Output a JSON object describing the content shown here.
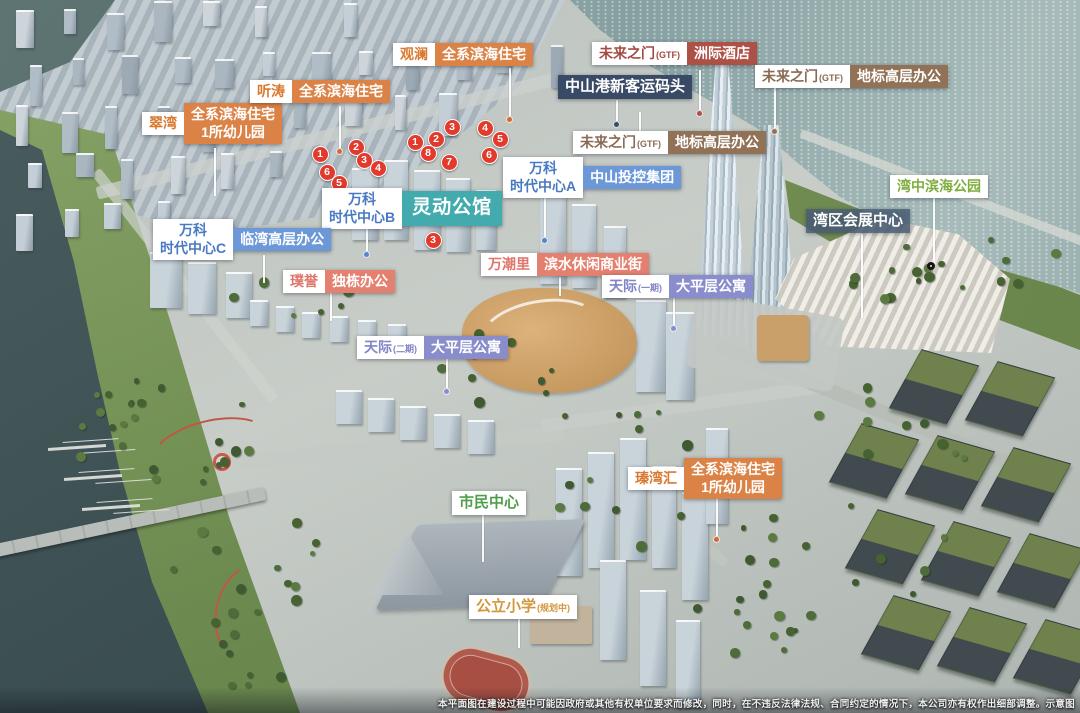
{
  "labels": {
    "cuiwan": {
      "name": "翠湾",
      "desc1": "全系滨海住宅",
      "desc2": "1所幼儿园"
    },
    "tingtao": {
      "name": "听涛",
      "desc": "全系滨海住宅"
    },
    "guanlan": {
      "name": "观澜",
      "desc": "全系滨海住宅"
    },
    "gangkou": {
      "name": "中山港新客运码头"
    },
    "weilai_hotel": {
      "name": "未来之门",
      "suffix": "(GTF)",
      "desc": "洲际酒店"
    },
    "weilai_right": {
      "name": "未来之门",
      "suffix": "(GTF)",
      "desc": "地标高层办公"
    },
    "weilai_lower": {
      "name": "未来之门",
      "suffix": "(GTF)",
      "desc": "地标高层办公"
    },
    "vanke_a": {
      "name1": "万科",
      "name2": "时代中心A",
      "desc": "中山投控集团"
    },
    "vanke_b": {
      "name1": "万科",
      "name2": "时代中心B",
      "desc": "灵动公馆"
    },
    "vanke_c": {
      "name1": "万科",
      "name2": "时代中心C",
      "desc": "临湾高层办公"
    },
    "puyu": {
      "name": "璞誉",
      "desc": "独栋办公"
    },
    "wanchaoli": {
      "name": "万潮里",
      "desc": "滨水休闲商业街"
    },
    "tianji1": {
      "name": "天际",
      "suffix": "(一期)",
      "desc": "大平层公寓"
    },
    "tianji2": {
      "name": "天际",
      "suffix": "(二期)",
      "desc": "大平层公寓"
    },
    "huizhan": {
      "name": "湾区会展中心"
    },
    "binhai_park": {
      "name": "湾中滨海公园"
    },
    "zhenwanhui": {
      "name": "瑧湾汇",
      "desc1": "全系滨海住宅",
      "desc2": "1所幼儿园"
    },
    "shimin": {
      "name": "市民中心"
    },
    "xiaoxue": {
      "name": "公立小学",
      "suffix": "(规划中)"
    }
  },
  "markers": [
    {
      "n": "1",
      "x": 320,
      "y": 154
    },
    {
      "n": "2",
      "x": 356,
      "y": 147
    },
    {
      "n": "3",
      "x": 364,
      "y": 160
    },
    {
      "n": "4",
      "x": 378,
      "y": 168
    },
    {
      "n": "6",
      "x": 327,
      "y": 172
    },
    {
      "n": "5",
      "x": 339,
      "y": 183
    },
    {
      "n": "1",
      "x": 415,
      "y": 142
    },
    {
      "n": "2",
      "x": 436,
      "y": 139
    },
    {
      "n": "3",
      "x": 452,
      "y": 127
    },
    {
      "n": "8",
      "x": 428,
      "y": 153
    },
    {
      "n": "7",
      "x": 449,
      "y": 162
    },
    {
      "n": "4",
      "x": 485,
      "y": 128
    },
    {
      "n": "5",
      "x": 500,
      "y": 139
    },
    {
      "n": "6",
      "x": 489,
      "y": 155
    },
    {
      "n": "3",
      "x": 433,
      "y": 240
    }
  ],
  "disclaimer": "本平面图在建设过程中可能因政府或其他有权单位要求而修改，同时，在不违反法律法规、合同约定的情况下，本公司亦有权作出细部调整。示意图",
  "colors": {
    "residential_orange": "#db8346",
    "office_blue": "#6d98d8",
    "apartment_purple": "#8a8dcc",
    "hotel_maroon": "#ad5147",
    "landmark_brown": "#927257",
    "commercial_salmon": "#e4806f",
    "mansion_teal": "#43abae",
    "port_navy": "#394a66",
    "park_green": "#7fae3d",
    "marker_red": "#e23a2c"
  }
}
